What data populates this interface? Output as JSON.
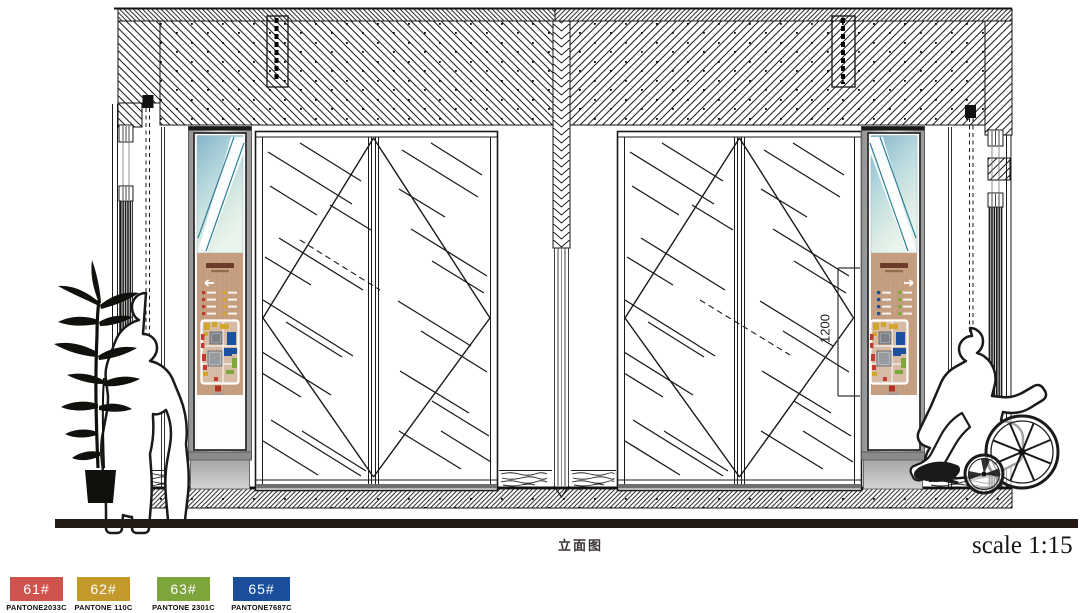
{
  "drawing": {
    "title": "立面图",
    "scale_label": "scale 1:15",
    "dimension_label": "1200"
  },
  "legend": {
    "items": [
      {
        "code": "61#",
        "pantone": "PANTONE2033C",
        "color": "#d0544e"
      },
      {
        "code": "62#",
        "pantone": "PANTONE 110C",
        "color": "#c3992b"
      },
      {
        "code": "63#",
        "pantone": "PANTONE 2301C",
        "color": "#7ea43c"
      },
      {
        "code": "65#",
        "pantone": "PANTONE7687C",
        "color": "#1b4f9c"
      }
    ]
  }
}
